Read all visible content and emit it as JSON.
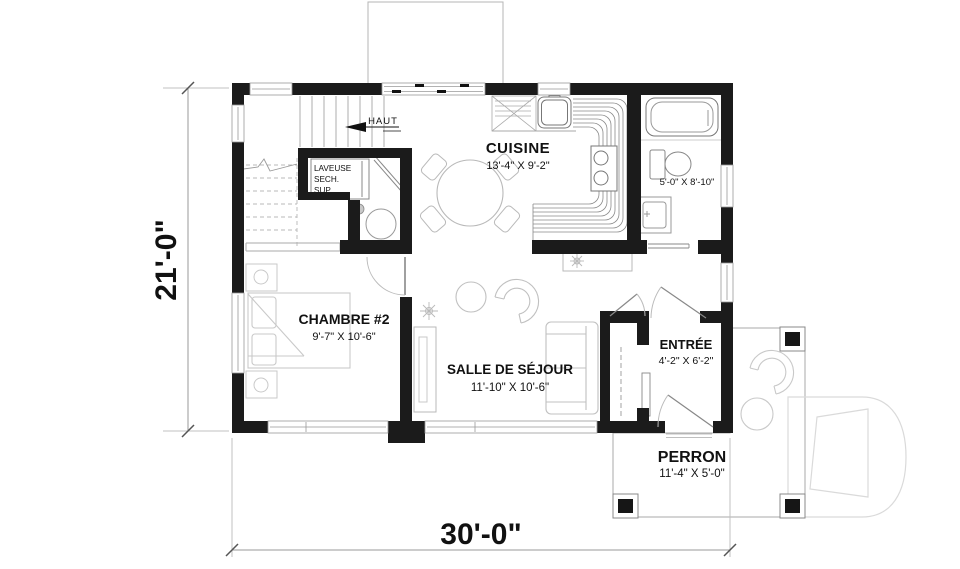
{
  "plan": {
    "rooms": [
      {
        "id": "cuisine",
        "name": "CUISINE",
        "dims": "13'-4\" X 9'-2\""
      },
      {
        "id": "chambre2",
        "name": "CHAMBRE #2",
        "dims": "9'-7\" X 10'-6\""
      },
      {
        "id": "sejour",
        "name": "SALLE DE SÉJOUR",
        "dims": "11'-10\" X 10'-6\""
      },
      {
        "id": "entree",
        "name": "ENTRÉE",
        "dims": "4'-2\" X 6'-2\""
      },
      {
        "id": "perron",
        "name": "PERRON",
        "dims": "11'-4\" X 5'-0\""
      }
    ],
    "bathroom": {
      "dims": "5'-0\" X 8'-10\""
    },
    "stairs": {
      "label": "HAUT"
    },
    "laundry": {
      "line1": "LAVEUSE",
      "line2": "SECH.",
      "line3": "SUP."
    },
    "overall_dimensions": {
      "width": "30'-0\"",
      "height": "21'-0\""
    },
    "colors": {
      "wall": "#1b1b1b",
      "furniture": "#c4c4c4",
      "fixture": "#777777",
      "stair": "#999999",
      "dimension_text": "#111111",
      "watermark": "#dadada"
    }
  }
}
